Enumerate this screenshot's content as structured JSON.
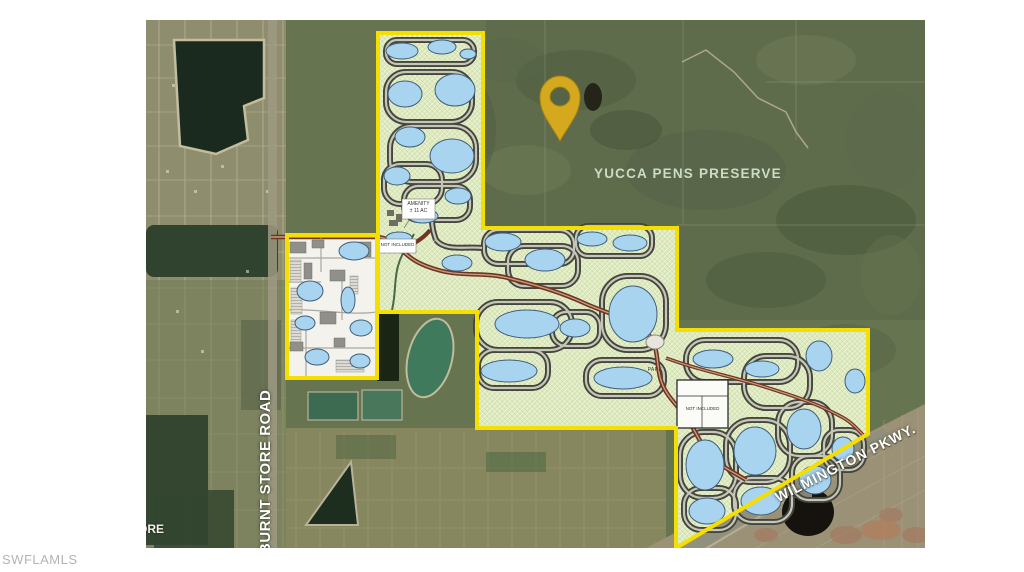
{
  "watermark": {
    "text": "SWFLAMLS"
  },
  "map": {
    "region_labels": {
      "preserve": "YUCCA PENS PRESERVE"
    },
    "road_labels": {
      "burnt_store": "BURNT STORE ROAD",
      "wilmington": "WILMINGTON PKWY.",
      "fragment": "ORE"
    },
    "plan_labels": {
      "amenity_line1": "AMENITY",
      "amenity_line2": "± 11 AC",
      "not_included_upper": "NOT INCLUDED",
      "not_included_lower": "NOT INCLUDED",
      "park": "PARK"
    },
    "marker": {
      "type": "location-pin",
      "color": "#D5A91E"
    },
    "colors": {
      "boundary_yellow": "#F5DF00",
      "plan_green": "#DDE9BC",
      "lake_blue": "#A8D4F0",
      "pin_gold": "#D5A91E",
      "preserve_text": "#CBDCC5",
      "satellite_base": "#66744F"
    }
  }
}
